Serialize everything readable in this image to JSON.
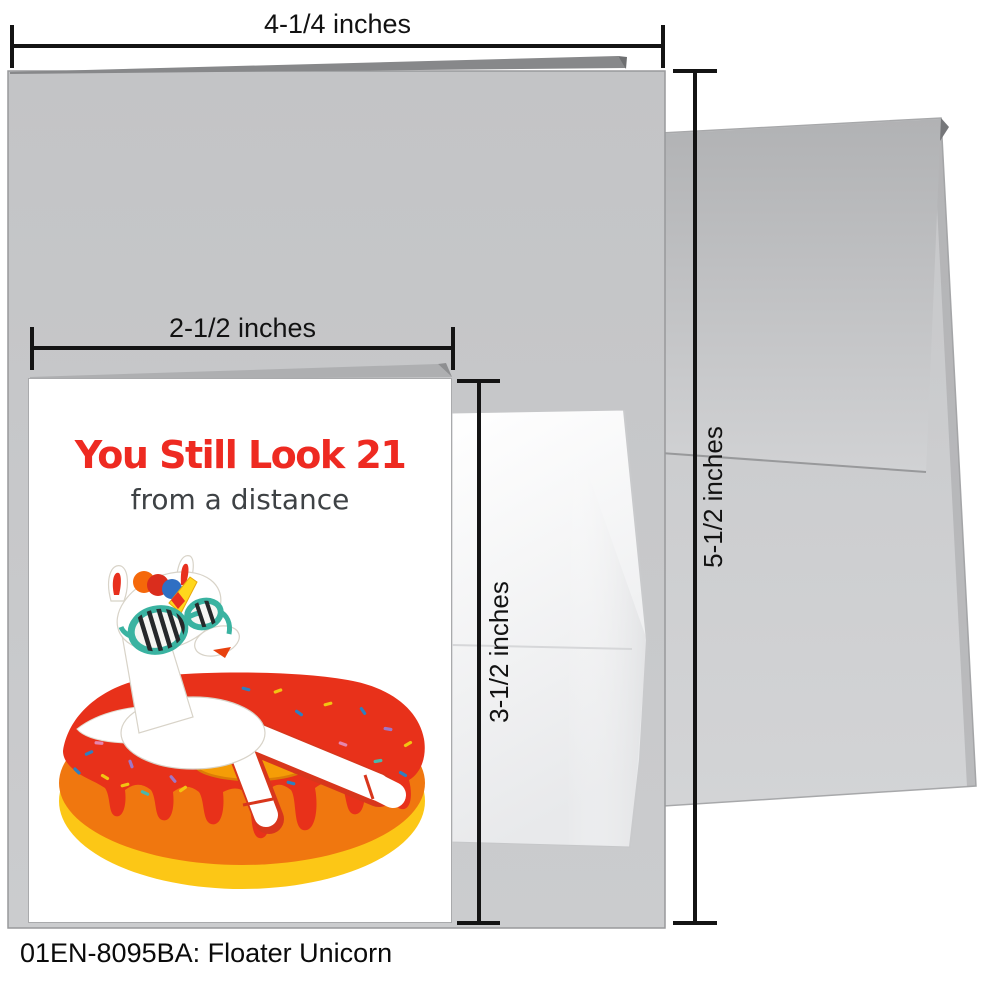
{
  "page": {
    "caption": "01EN-8095BA: Floater Unicorn"
  },
  "dimensions": {
    "folded_card_width": {
      "label": "4-1/4 inches"
    },
    "folded_card_height": {
      "label": "5-1/2 inches"
    },
    "front_card_width": {
      "label": "2-1/2 inches"
    },
    "front_card_height": {
      "label": "3-1/2 inches"
    }
  },
  "card_front": {
    "title": "You Still Look 21",
    "subtitle": "from a distance",
    "title_color": "#ee2a21",
    "subtitle_color": "#3e4245"
  },
  "materials": {
    "card_gray_top": "#c3c4c6",
    "card_gray_bottom": "#cbccce",
    "card_edge": "#98999b",
    "card_fold_dark": "#87888a",
    "card_fold_notch": "#6e6f71",
    "small_card_fold": "#aeafb1",
    "small_card_fold_dark": "#8e8f91",
    "envelope_flap_top": "#b1b2b4",
    "envelope_flap_bottom": "#d1d2d4",
    "envelope_body_top": "#c5c6c8",
    "envelope_body_bottom": "#d3d4d6",
    "envelope_notch": "#76777a",
    "inner_envelope_top": "#ffffff",
    "inner_envelope_bottom": "#e8e9eb",
    "dimension_line": "#141414"
  },
  "illustration": {
    "name": "floater-unicorn",
    "colors": {
      "frosting": "#e8311a",
      "icing_band": "#f0770f",
      "tube": "#fcc716",
      "hole": "#f59d07",
      "hole_edge": "#dc7d06",
      "body": "#ffffff",
      "body_edge": "#d8d3c8",
      "outline_red": "#d8361c",
      "glasses": "#3ab3a1",
      "lens_fill": "#f6f6f3",
      "lens_stripe": "#26282a",
      "horn": "#ffd71c",
      "horn_edge": "#e9a70c",
      "horn_stripe": "#e8301e",
      "ear_inner": "#e8301e",
      "mane_orange": "#f5680a",
      "mane_red": "#da2d1d",
      "mane_blue": "#2f6fc3",
      "nostril": "#e8410e"
    },
    "sprinkle_colors": {
      "blue": "#2e7fc0",
      "yellow": "#f2c412",
      "purple": "#9f77c6",
      "pink": "#e585ae",
      "teal": "#4ab8ac"
    }
  }
}
